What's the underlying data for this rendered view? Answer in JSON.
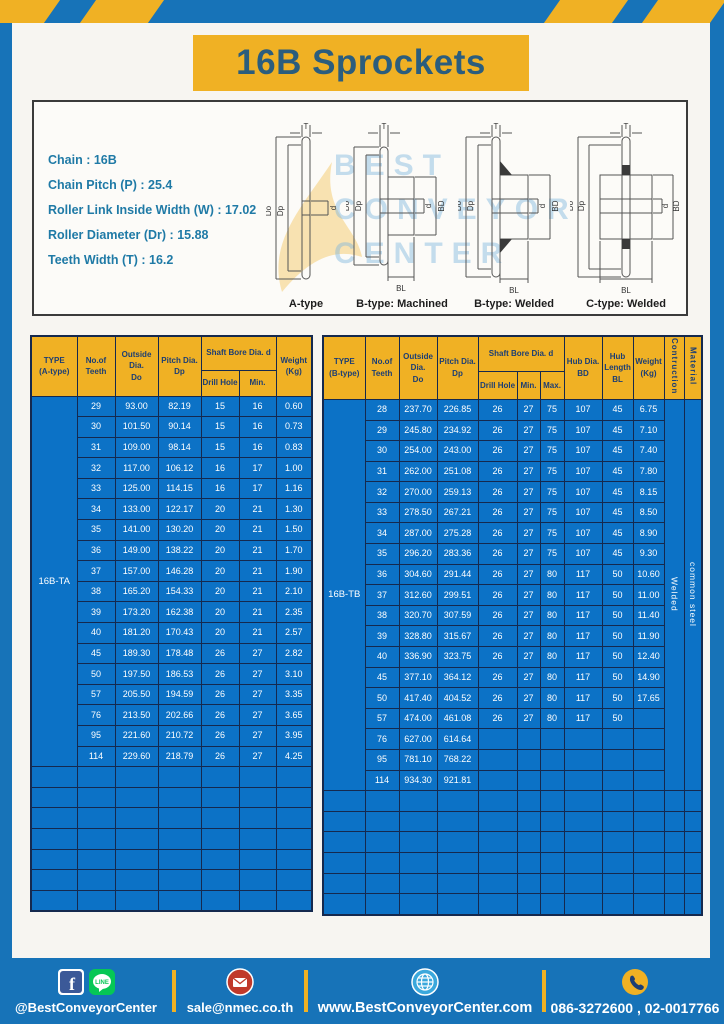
{
  "title": "16B Sprockets",
  "specs": [
    "Chain  :  16B",
    "Chain Pitch (P)  :  25.4",
    "Roller Link Inside Width (W)  :  17.02",
    "Roller Diameter (Dr)  : 15.88",
    "Teeth Width (T)  :  16.2"
  ],
  "diagram": {
    "dims": {
      "T": "T",
      "Do": "Do",
      "Dp": "Dp",
      "d": "d",
      "BD": "BD",
      "BL": "BL"
    },
    "figures": [
      "A-type",
      "B-type: Machined",
      "B-type: Welded",
      "C-type: Welded"
    ],
    "watermark_lines": [
      "BEST",
      "CONVEYOR",
      "CENTER"
    ]
  },
  "left_table": {
    "headers": {
      "type": "TYPE\n(A-type)",
      "teeth": "No.of\nTeeth",
      "outside": "Outside\nDia.\nDo",
      "pitch": "Pitch Dia.\nDp",
      "shaft_bore": "Shaft Bore Dia. d",
      "drill": "Drill Hole",
      "min": "Min.",
      "weight": "Weight\n(Kg)"
    },
    "type_label": "16B-TA",
    "total_cols": 7,
    "empty_rows": 7,
    "rows": [
      [
        "29",
        "93.00",
        "82.19",
        "15",
        "16",
        "0.60"
      ],
      [
        "30",
        "101.50",
        "90.14",
        "15",
        "16",
        "0.73"
      ],
      [
        "31",
        "109.00",
        "98.14",
        "15",
        "16",
        "0.83"
      ],
      [
        "32",
        "117.00",
        "106.12",
        "16",
        "17",
        "1.00"
      ],
      [
        "33",
        "125.00",
        "114.15",
        "16",
        "17",
        "1.16"
      ],
      [
        "34",
        "133.00",
        "122.17",
        "20",
        "21",
        "1.30"
      ],
      [
        "35",
        "141.00",
        "130.20",
        "20",
        "21",
        "1.50"
      ],
      [
        "36",
        "149.00",
        "138.22",
        "20",
        "21",
        "1.70"
      ],
      [
        "37",
        "157.00",
        "146.28",
        "20",
        "21",
        "1.90"
      ],
      [
        "38",
        "165.20",
        "154.33",
        "20",
        "21",
        "2.10"
      ],
      [
        "39",
        "173.20",
        "162.38",
        "20",
        "21",
        "2.35"
      ],
      [
        "40",
        "181.20",
        "170.43",
        "20",
        "21",
        "2.57"
      ],
      [
        "45",
        "189.30",
        "178.48",
        "26",
        "27",
        "2.82"
      ],
      [
        "50",
        "197.50",
        "186.53",
        "26",
        "27",
        "3.10"
      ],
      [
        "57",
        "205.50",
        "194.59",
        "26",
        "27",
        "3.35"
      ],
      [
        "76",
        "213.50",
        "202.66",
        "26",
        "27",
        "3.65"
      ],
      [
        "95",
        "221.60",
        "210.72",
        "26",
        "27",
        "3.95"
      ],
      [
        "114",
        "229.60",
        "218.79",
        "26",
        "27",
        "4.25"
      ]
    ]
  },
  "right_table": {
    "headers": {
      "type": "TYPE\n(B-type)",
      "teeth": "No.of\nTeeth",
      "outside": "Outside\nDia.\nDo",
      "pitch": "Pitch Dia.\nDp",
      "shaft_bore": "Shaft Bore Dia. d",
      "drill": "Drill Hole",
      "min": "Min.",
      "max": "Max.",
      "hub_dia": "Hub Dia.\nBD",
      "hub_len": "Hub\nLength\nBL",
      "weight": "Weight\n(Kg)",
      "construction": "Contruction",
      "material": "Material"
    },
    "type_label": "16B-TB",
    "total_cols": 12,
    "empty_rows": 6,
    "merged_tail": [
      {
        "name": "construction-cell",
        "text": "Welded"
      },
      {
        "name": "material-cell",
        "text": "common steel"
      }
    ],
    "rows": [
      [
        "28",
        "237.70",
        "226.85",
        "26",
        "27",
        "75",
        "107",
        "45",
        "6.75"
      ],
      [
        "29",
        "245.80",
        "234.92",
        "26",
        "27",
        "75",
        "107",
        "45",
        "7.10"
      ],
      [
        "30",
        "254.00",
        "243.00",
        "26",
        "27",
        "75",
        "107",
        "45",
        "7.40"
      ],
      [
        "31",
        "262.00",
        "251.08",
        "26",
        "27",
        "75",
        "107",
        "45",
        "7.80"
      ],
      [
        "32",
        "270.00",
        "259.13",
        "26",
        "27",
        "75",
        "107",
        "45",
        "8.15"
      ],
      [
        "33",
        "278.50",
        "267.21",
        "26",
        "27",
        "75",
        "107",
        "45",
        "8.50"
      ],
      [
        "34",
        "287.00",
        "275.28",
        "26",
        "27",
        "75",
        "107",
        "45",
        "8.90"
      ],
      [
        "35",
        "296.20",
        "283.36",
        "26",
        "27",
        "75",
        "107",
        "45",
        "9.30"
      ],
      [
        "36",
        "304.60",
        "291.44",
        "26",
        "27",
        "80",
        "117",
        "50",
        "10.60"
      ],
      [
        "37",
        "312.60",
        "299.51",
        "26",
        "27",
        "80",
        "117",
        "50",
        "11.00"
      ],
      [
        "38",
        "320.70",
        "307.59",
        "26",
        "27",
        "80",
        "117",
        "50",
        "11.40"
      ],
      [
        "39",
        "328.80",
        "315.67",
        "26",
        "27",
        "80",
        "117",
        "50",
        "11.90"
      ],
      [
        "40",
        "336.90",
        "323.75",
        "26",
        "27",
        "80",
        "117",
        "50",
        "12.40"
      ],
      [
        "45",
        "377.10",
        "364.12",
        "26",
        "27",
        "80",
        "117",
        "50",
        "14.90"
      ],
      [
        "50",
        "417.40",
        "404.52",
        "26",
        "27",
        "80",
        "117",
        "50",
        "17.65"
      ],
      [
        "57",
        "474.00",
        "461.08",
        "26",
        "27",
        "80",
        "117",
        "50",
        ""
      ],
      [
        "76",
        "627.00",
        "614.64",
        "",
        "",
        "",
        "",
        "",
        ""
      ],
      [
        "95",
        "781.10",
        "768.22",
        "",
        "",
        "",
        "",
        "",
        ""
      ],
      [
        "114",
        "934.30",
        "921.81",
        "",
        "",
        "",
        "",
        "",
        ""
      ]
    ]
  },
  "footer": {
    "items": [
      {
        "icons": [
          "facebook-icon",
          "line-icon"
        ],
        "label": "@BestConveyorCenter"
      },
      {
        "icons": [
          "email-icon"
        ],
        "label": "sale@nmec.co.th"
      },
      {
        "icons": [
          "globe-icon"
        ],
        "label": "www.BestConveyorCenter.com"
      },
      {
        "icons": [
          "phone-icon"
        ],
        "label": "086-3272600 , 02-0017766"
      }
    ]
  },
  "colors": {
    "frame_blue": "#1773B8",
    "accent_yellow": "#F0B124",
    "table_blue": "#0C72C6",
    "header_text_navy": "#1C3E74",
    "title_text": "#2B5D7D",
    "spec_text_teal": "#1F7AA6",
    "grid_line": "#15294E",
    "email_red": "#C0392B",
    "line_green": "#06C755",
    "facebook_blue": "#3B5998",
    "globe_blue": "#3BA8DC"
  }
}
